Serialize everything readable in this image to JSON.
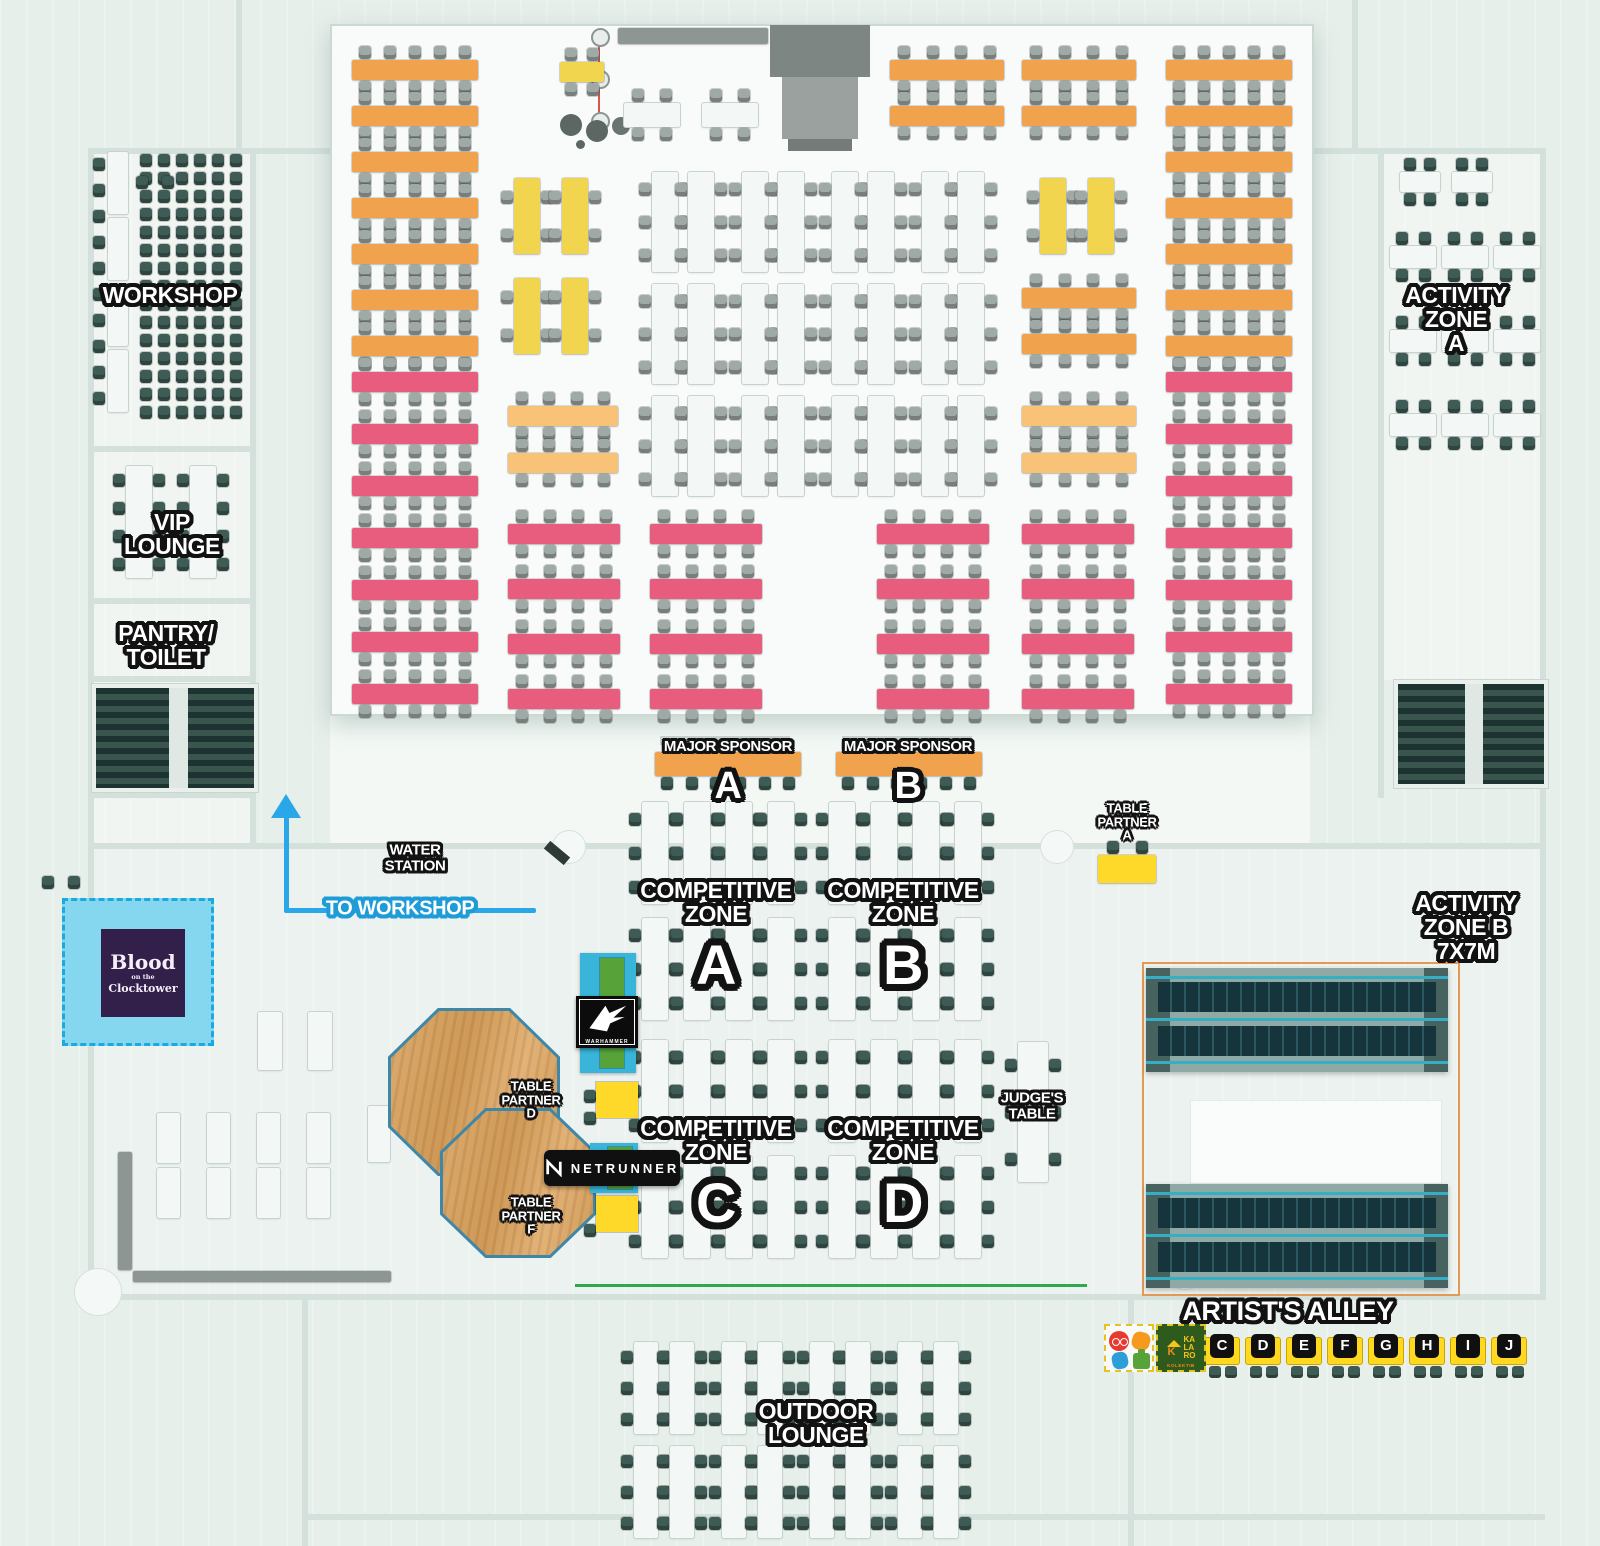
{
  "palette": {
    "bg": "#e7efeb",
    "hall": "#f8fbf9",
    "floor": "#ecf2ef",
    "wall": "#d4e0db",
    "orange": "#f0a24c",
    "peach": "#f8c377",
    "yellow": "#f2d54e",
    "bright_yellow": "#ffd929",
    "pink": "#e85c7d",
    "white_table": "#f3f7f5",
    "chair_gray": "#9fa9a6",
    "chair_teal": "#3e5b55",
    "cyan_station": "#38b5d8",
    "green_station": "#57a33a",
    "blue_area": "#84d7ef",
    "blue_dash": "#1ba9de",
    "purple": "#33204a",
    "wood": "#d9a96b",
    "wood_trim": "#3f87a6",
    "arrow_blue": "#2aa7e8",
    "green_line": "#2fa84f",
    "zoneb_border": "#e39a55",
    "bleacher": "#16343c",
    "bleacher_line": "#35aec6",
    "stage_gray": "#8e9693",
    "stair": "#25403c",
    "label_outline": "#121212"
  },
  "labels": {
    "workshop": "WORKSHOP",
    "vip_lounge": "VIP\nLOUNGE",
    "pantry_toilet": "PANTRY/\nTOILET",
    "activity_zone_a": "ACTIVITY\nZONE\nA",
    "activity_zone_b": "ACTIVITY\nZONE B\n7X7M",
    "water_station": "WATER\nSTATION",
    "to_workshop": "TO WORKSHOP",
    "judges_table": "JUDGE'S\nTABLE",
    "outdoor_lounge": "OUTDOOR\nLOUNGE"
  },
  "major_sponsors": [
    {
      "label": "MAJOR SPONSOR",
      "letter": "A"
    },
    {
      "label": "MAJOR SPONSOR",
      "letter": "B"
    }
  ],
  "competitive_zones": [
    {
      "label": "COMPETITIVE\nZONE",
      "letter": "A"
    },
    {
      "label": "COMPETITIVE\nZONE",
      "letter": "B"
    },
    {
      "label": "COMPETITIVE\nZONE",
      "letter": "C"
    },
    {
      "label": "COMPETITIVE\nZONE",
      "letter": "D"
    }
  ],
  "table_partners": [
    {
      "label": "TABLE\nPARTNER\nA"
    },
    {
      "label": "TABLE\nPARTNER\nD"
    },
    {
      "label": "TABLE\nPARTNER\nF"
    }
  ],
  "logos": {
    "blood_clocktower": {
      "line1": "Blood",
      "line2": "on the",
      "line3": "Clocktower"
    },
    "warhammer": "WARHAMMER",
    "netrunner": "NETRUNNER",
    "kalaro": {
      "name": "KA\nLA\nRO",
      "sub": "KOLEKTIB"
    }
  },
  "artists_alley": {
    "label": "ARTIST'S ALLEY",
    "letters": [
      "C",
      "D",
      "E",
      "F",
      "G",
      "H",
      "I",
      "J"
    ]
  },
  "furniture": [
    {
      "t": "rows",
      "x": 352,
      "y": 60,
      "w": 126,
      "h": 20,
      "n": 7,
      "sy": 46,
      "c": "orange",
      "ch": "gray",
      "nc": 5
    },
    {
      "t": "rows",
      "x": 352,
      "y": 372,
      "w": 126,
      "h": 20,
      "n": 7,
      "sy": 52,
      "c": "pink",
      "ch": "gray",
      "nc": 5
    },
    {
      "t": "rows",
      "x": 560,
      "y": 62,
      "w": 44,
      "h": 20,
      "n": 1,
      "sy": 0,
      "c": "yellow",
      "ch": "gray",
      "nc": 2
    },
    {
      "t": "rows",
      "x": 624,
      "y": 103,
      "w": 56,
      "h": 24,
      "n": 1,
      "sy": 0,
      "c": "white_table",
      "ch": "gray",
      "nc": 2
    },
    {
      "t": "rows",
      "x": 702,
      "y": 103,
      "w": 56,
      "h": 24,
      "n": 1,
      "sy": 0,
      "c": "white_table",
      "ch": "gray",
      "nc": 2
    },
    {
      "t": "cols",
      "x": 514,
      "y": 178,
      "w": 26,
      "h": 76,
      "nx": 2,
      "ny": 2,
      "sx": 48,
      "sy": 100,
      "c": "yellow",
      "ch": "gray",
      "nc": 2
    },
    {
      "t": "rows",
      "x": 508,
      "y": 406,
      "w": 110,
      "h": 20,
      "n": 2,
      "sy": 47,
      "c": "peach",
      "ch": "gray",
      "nc": 4
    },
    {
      "t": "rows",
      "x": 508,
      "y": 524,
      "w": 112,
      "h": 20,
      "n": 4,
      "sy": 55,
      "c": "pink",
      "ch": "gray",
      "nc": 4
    },
    {
      "t": "cols",
      "x": 652,
      "y": 172,
      "w": 26,
      "h": 100,
      "nx": 2,
      "ny": 3,
      "sx": 36,
      "sy": 112,
      "c": "white_table",
      "ch": "gray",
      "nc": 3
    },
    {
      "t": "cols",
      "x": 742,
      "y": 172,
      "w": 26,
      "h": 100,
      "nx": 2,
      "ny": 3,
      "sx": 36,
      "sy": 112,
      "c": "white_table",
      "ch": "gray",
      "nc": 3
    },
    {
      "t": "cols",
      "x": 832,
      "y": 172,
      "w": 26,
      "h": 100,
      "nx": 2,
      "ny": 3,
      "sx": 36,
      "sy": 112,
      "c": "white_table",
      "ch": "gray",
      "nc": 3
    },
    {
      "t": "cols",
      "x": 922,
      "y": 172,
      "w": 26,
      "h": 100,
      "nx": 2,
      "ny": 3,
      "sx": 36,
      "sy": 112,
      "c": "white_table",
      "ch": "gray",
      "nc": 3
    },
    {
      "t": "rows",
      "x": 650,
      "y": 524,
      "w": 112,
      "h": 20,
      "n": 4,
      "sy": 55,
      "c": "pink",
      "ch": "gray",
      "nc": 4
    },
    {
      "t": "rows",
      "x": 877,
      "y": 524,
      "w": 112,
      "h": 20,
      "n": 4,
      "sy": 55,
      "c": "pink",
      "ch": "gray",
      "nc": 4
    },
    {
      "t": "rows",
      "x": 1022,
      "y": 524,
      "w": 112,
      "h": 20,
      "n": 4,
      "sy": 55,
      "c": "pink",
      "ch": "gray",
      "nc": 4
    },
    {
      "t": "rows",
      "x": 890,
      "y": 60,
      "w": 114,
      "h": 20,
      "n": 2,
      "sy": 46,
      "c": "orange",
      "ch": "gray",
      "nc": 4
    },
    {
      "t": "rows",
      "x": 1022,
      "y": 60,
      "w": 114,
      "h": 20,
      "n": 2,
      "sy": 46,
      "c": "orange",
      "ch": "gray",
      "nc": 4
    },
    {
      "t": "cols",
      "x": 1040,
      "y": 178,
      "w": 26,
      "h": 76,
      "nx": 2,
      "ny": 1,
      "sx": 48,
      "sy": 0,
      "c": "yellow",
      "ch": "gray",
      "nc": 2
    },
    {
      "t": "rows",
      "x": 1022,
      "y": 288,
      "w": 114,
      "h": 20,
      "n": 2,
      "sy": 46,
      "c": "orange",
      "ch": "gray",
      "nc": 4
    },
    {
      "t": "rows",
      "x": 1022,
      "y": 406,
      "w": 114,
      "h": 20,
      "n": 2,
      "sy": 47,
      "c": "peach",
      "ch": "gray",
      "nc": 4
    },
    {
      "t": "rows",
      "x": 1166,
      "y": 60,
      "w": 126,
      "h": 20,
      "n": 7,
      "sy": 46,
      "c": "orange",
      "ch": "gray",
      "nc": 5
    },
    {
      "t": "rows",
      "x": 1166,
      "y": 372,
      "w": 126,
      "h": 20,
      "n": 7,
      "sy": 52,
      "c": "pink",
      "ch": "gray",
      "nc": 5
    },
    {
      "t": "rows",
      "x": 655,
      "y": 752,
      "w": 146,
      "h": 24,
      "n": 1,
      "sy": 0,
      "c": "orange",
      "ch": "teal",
      "nc": 6,
      "sides": "b"
    },
    {
      "t": "rows",
      "x": 836,
      "y": 752,
      "w": 146,
      "h": 24,
      "n": 1,
      "sy": 0,
      "c": "orange",
      "ch": "teal",
      "nc": 6,
      "sides": "b"
    },
    {
      "t": "rows",
      "x": 1098,
      "y": 855,
      "w": 58,
      "h": 28,
      "n": 1,
      "sy": 0,
      "c": "bright_yellow",
      "ch": "teal",
      "nc": 2,
      "sides": "t"
    },
    {
      "t": "cols",
      "x": 642,
      "y": 802,
      "w": 26,
      "h": 102,
      "nx": 4,
      "ny": 2,
      "sx": 42,
      "sy": 116,
      "c": "white_table",
      "ch": "teal",
      "nc": 3
    },
    {
      "t": "cols",
      "x": 829,
      "y": 802,
      "w": 26,
      "h": 102,
      "nx": 4,
      "ny": 2,
      "sx": 42,
      "sy": 116,
      "c": "white_table",
      "ch": "teal",
      "nc": 3
    },
    {
      "t": "cols",
      "x": 642,
      "y": 1040,
      "w": 26,
      "h": 102,
      "nx": 4,
      "ny": 2,
      "sx": 42,
      "sy": 116,
      "c": "white_table",
      "ch": "teal",
      "nc": 3
    },
    {
      "t": "cols",
      "x": 829,
      "y": 1040,
      "w": 26,
      "h": 102,
      "nx": 4,
      "ny": 2,
      "sx": 42,
      "sy": 116,
      "c": "white_table",
      "ch": "teal",
      "nc": 3
    },
    {
      "t": "cols",
      "x": 1018,
      "y": 1042,
      "w": 30,
      "h": 140,
      "nx": 1,
      "ny": 1,
      "sx": 0,
      "sy": 0,
      "c": "white_table",
      "ch": "teal",
      "nc": 3
    },
    {
      "t": "grid",
      "x": 140,
      "y": 154,
      "nx": 6,
      "ny": 15,
      "sx": 18,
      "sy": 18,
      "ch": "teal"
    },
    {
      "t": "grid",
      "x": 93,
      "y": 158,
      "nx": 1,
      "ny": 10,
      "sx": 0,
      "sy": 26,
      "ch": "teal"
    },
    {
      "t": "cols",
      "x": 108,
      "y": 152,
      "w": 20,
      "h": 62,
      "nx": 1,
      "ny": 4,
      "sx": 0,
      "sy": 66,
      "c": "white_table",
      "ch": "gray",
      "nc": 0
    },
    {
      "t": "cols",
      "x": 126,
      "y": 466,
      "w": 26,
      "h": 112,
      "nx": 2,
      "ny": 1,
      "sx": 64,
      "sy": 0,
      "c": "white_table",
      "ch": "teal",
      "nc": 4
    },
    {
      "t": "rows",
      "x": 1400,
      "y": 172,
      "w": 40,
      "h": 20,
      "n": 1,
      "sy": 0,
      "c": "white_table",
      "ch": "teal",
      "nc": 2
    },
    {
      "t": "rows",
      "x": 1452,
      "y": 172,
      "w": 40,
      "h": 20,
      "n": 1,
      "sy": 0,
      "c": "white_table",
      "ch": "teal",
      "nc": 2
    },
    {
      "t": "rows",
      "x": 1390,
      "y": 246,
      "w": 46,
      "h": 22,
      "n": 3,
      "sy": 84,
      "c": "white_table",
      "ch": "teal",
      "nc": 2
    },
    {
      "t": "rows",
      "x": 1442,
      "y": 246,
      "w": 46,
      "h": 22,
      "n": 3,
      "sy": 84,
      "c": "white_table",
      "ch": "teal",
      "nc": 2
    },
    {
      "t": "rows",
      "x": 1494,
      "y": 246,
      "w": 46,
      "h": 22,
      "n": 3,
      "sy": 84,
      "c": "white_table",
      "ch": "teal",
      "nc": 2
    },
    {
      "t": "cols",
      "x": 258,
      "y": 1012,
      "w": 24,
      "h": 58,
      "nx": 2,
      "ny": 1,
      "sx": 50,
      "sy": 0,
      "c": "white_table",
      "ch": "gray",
      "nc": 0
    },
    {
      "t": "cols",
      "x": 157,
      "y": 1113,
      "w": 23,
      "h": 50,
      "nx": 4,
      "ny": 2,
      "sx": 50,
      "sy": 55,
      "c": "white_table",
      "ch": "gray",
      "nc": 0
    },
    {
      "t": "table",
      "x": 118,
      "y": 1152,
      "w": 14,
      "h": 118,
      "c": "stage_gray"
    },
    {
      "t": "table",
      "x": 133,
      "y": 1271,
      "w": 258,
      "h": 11,
      "c": "stage_gray"
    },
    {
      "t": "cols",
      "x": 634,
      "y": 1342,
      "w": 24,
      "h": 92,
      "nx": 2,
      "ny": 2,
      "sx": 36,
      "sy": 104,
      "c": "white_table",
      "ch": "teal",
      "nc": 3
    },
    {
      "t": "cols",
      "x": 722,
      "y": 1342,
      "w": 24,
      "h": 92,
      "nx": 2,
      "ny": 2,
      "sx": 36,
      "sy": 104,
      "c": "white_table",
      "ch": "teal",
      "nc": 3
    },
    {
      "t": "cols",
      "x": 810,
      "y": 1342,
      "w": 24,
      "h": 92,
      "nx": 2,
      "ny": 2,
      "sx": 36,
      "sy": 104,
      "c": "white_table",
      "ch": "teal",
      "nc": 3
    },
    {
      "t": "cols",
      "x": 898,
      "y": 1342,
      "w": 24,
      "h": 92,
      "nx": 2,
      "ny": 2,
      "sx": 36,
      "sy": 104,
      "c": "white_table",
      "ch": "teal",
      "nc": 3
    },
    {
      "t": "grid",
      "x": 42,
      "y": 876,
      "nx": 2,
      "ny": 1,
      "sx": 26,
      "sy": 0,
      "ch": "teal"
    },
    {
      "t": "grid",
      "x": 136,
      "y": 176,
      "nx": 2,
      "ny": 1,
      "sx": 26,
      "sy": 0,
      "ch": "teal"
    },
    {
      "t": "grid",
      "x": 582,
      "y": 962,
      "nx": 1,
      "ny": 3,
      "sx": 0,
      "sy": 36,
      "ch": "teal"
    },
    {
      "t": "grid",
      "x": 584,
      "y": 1090,
      "nx": 1,
      "ny": 2,
      "sx": 0,
      "sy": 22,
      "ch": "teal"
    },
    {
      "t": "grid",
      "x": 590,
      "y": 1150,
      "nx": 1,
      "ny": 2,
      "sx": 0,
      "sy": 24,
      "ch": "teal"
    },
    {
      "t": "grid",
      "x": 584,
      "y": 1202,
      "nx": 1,
      "ny": 2,
      "sx": 0,
      "sy": 22,
      "ch": "teal"
    },
    {
      "t": "table",
      "x": 368,
      "y": 1106,
      "w": 22,
      "h": 56,
      "c": "white_table"
    },
    {
      "t": "table",
      "x": 618,
      "y": 28,
      "w": 150,
      "h": 16,
      "c": "stage_gray"
    }
  ]
}
